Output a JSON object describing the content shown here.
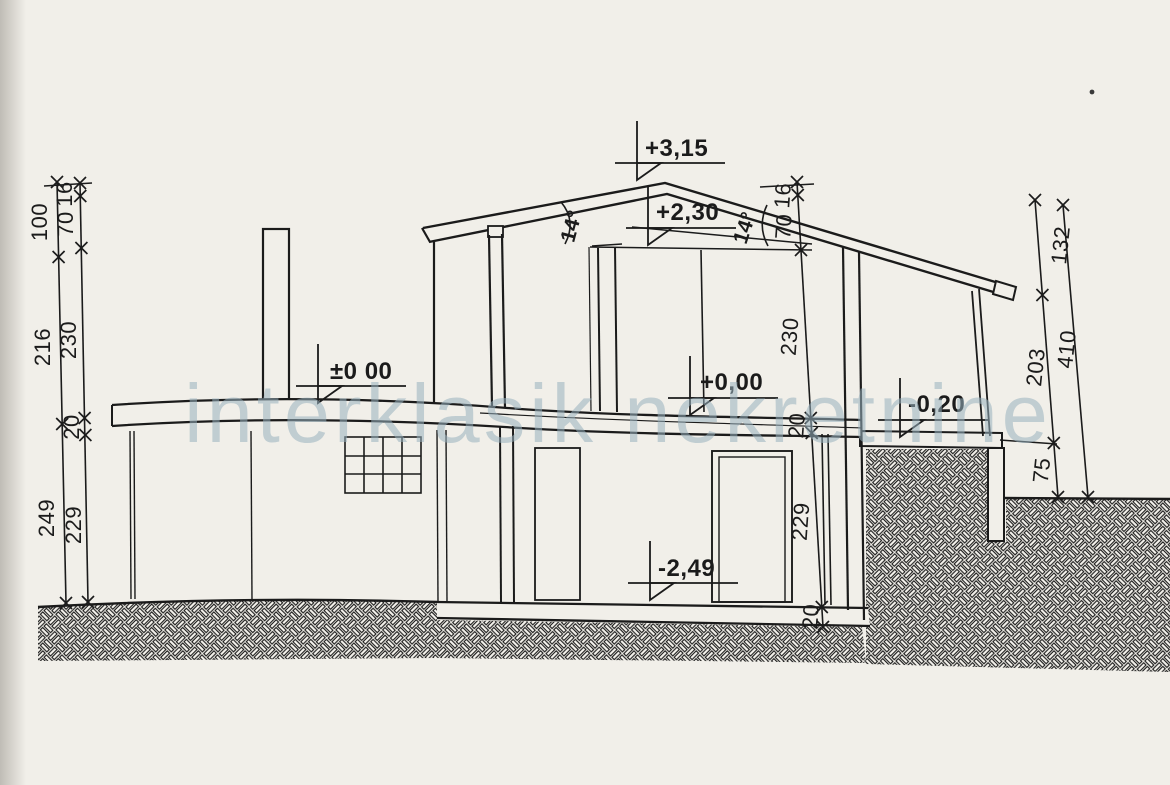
{
  "watermark": {
    "text": "interklasik nekretnine"
  },
  "elevations": {
    "ridge": "+3,15",
    "attic_floor": "+2,30",
    "ground_left": "±0 00",
    "ground_right": "+0,00",
    "terrace": "-0,20",
    "basement": "-2,49"
  },
  "angles": {
    "left": "14°",
    "right": "14°"
  },
  "dims": {
    "left_outer": [
      "100",
      "216",
      "249"
    ],
    "left_inner": [
      "16",
      "70",
      "230",
      "20",
      "229"
    ],
    "right_inner": [
      "16",
      "70",
      "230",
      "20",
      "229",
      "20"
    ],
    "far_right_segments": [
      "132",
      "203",
      "75"
    ],
    "far_right_total": "410"
  },
  "colors": {
    "ink": "#1b1b1b",
    "paper": "#f1efe9",
    "watermark": "#98b0be"
  }
}
